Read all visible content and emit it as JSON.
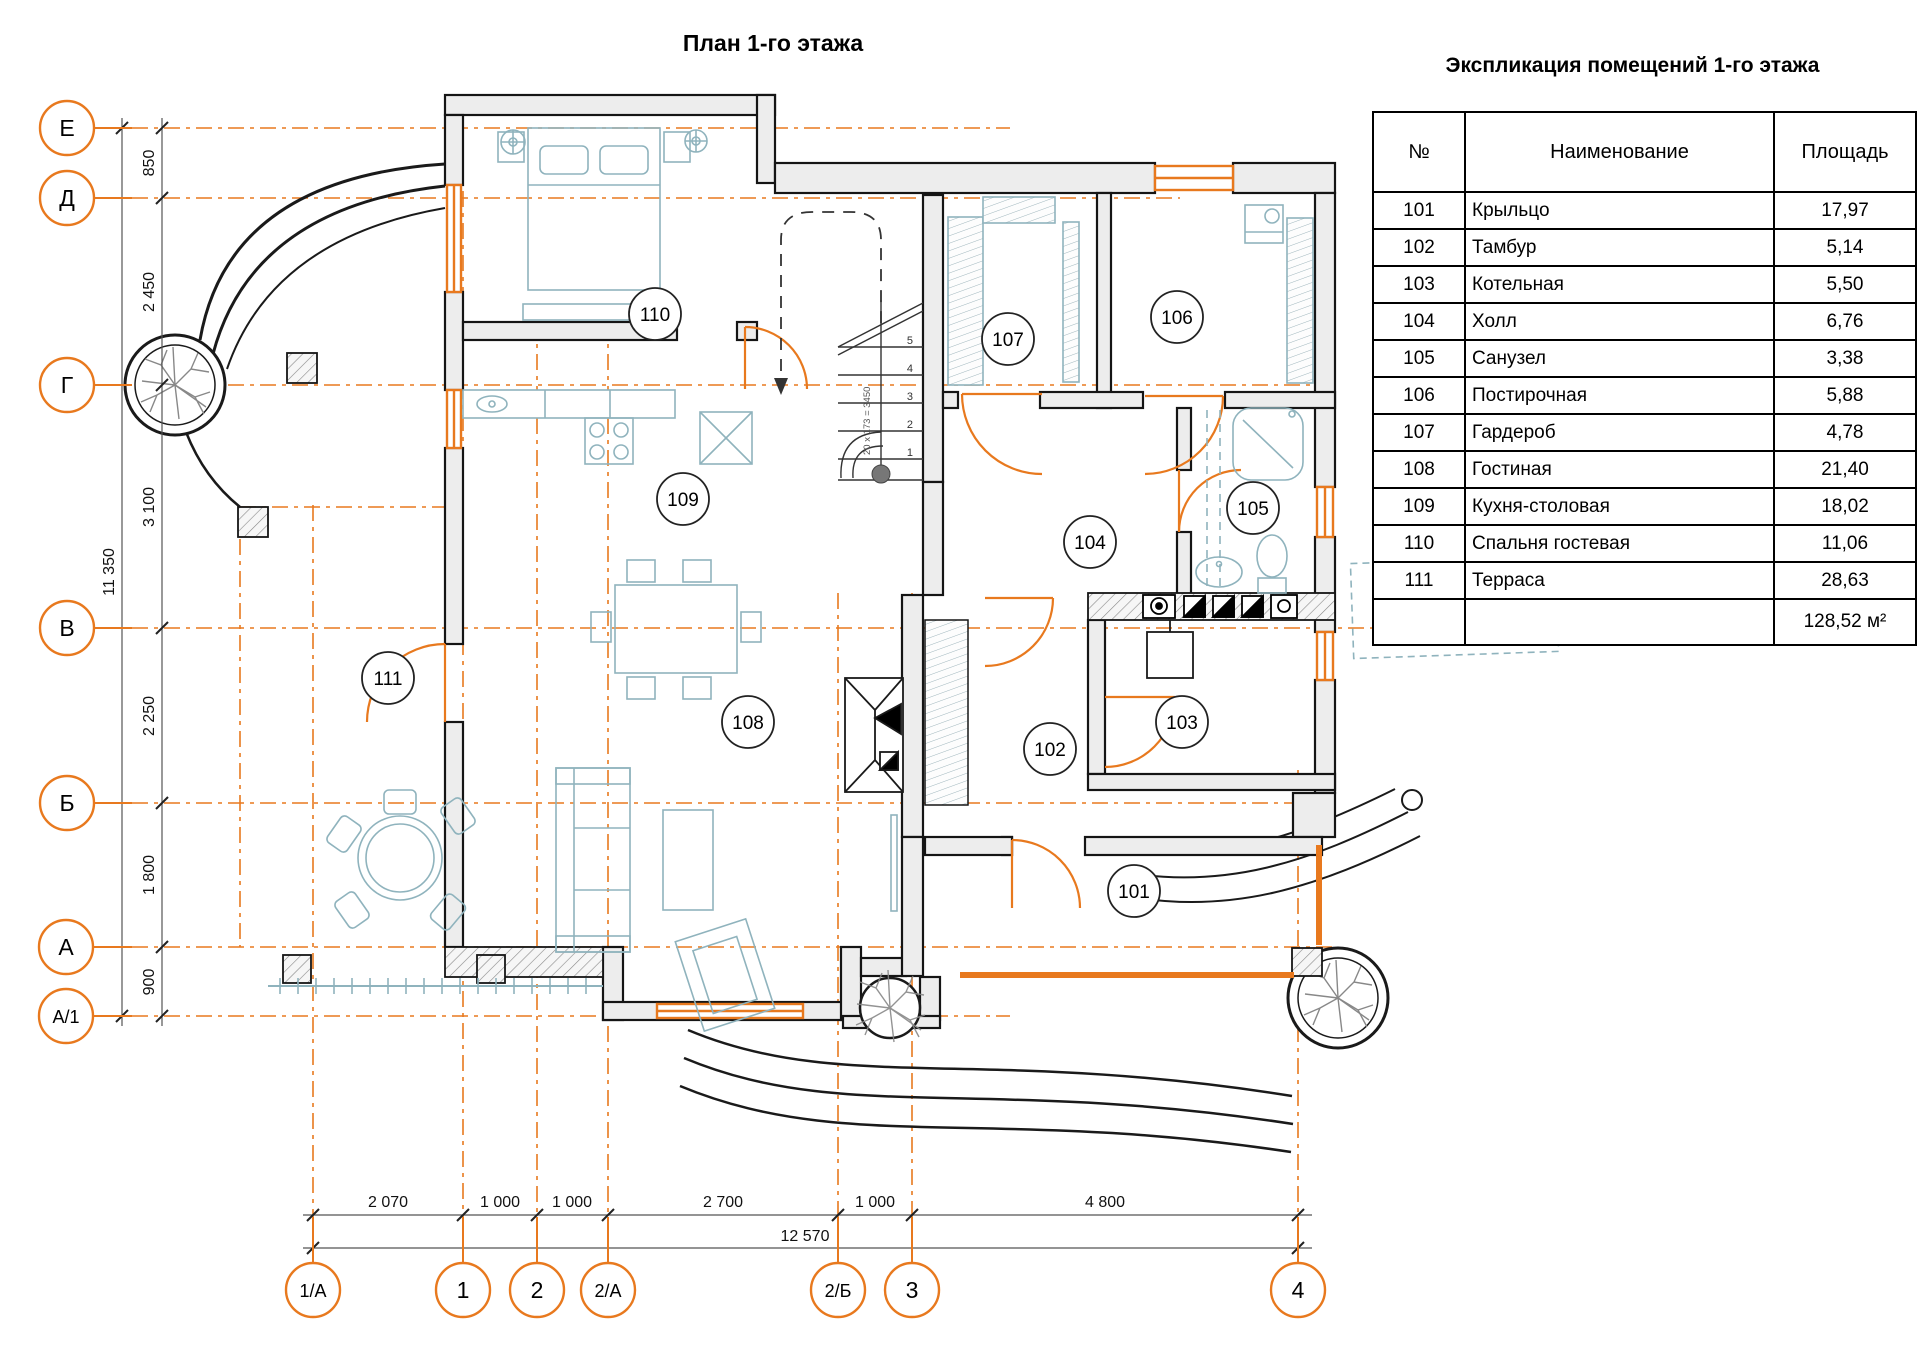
{
  "page": {
    "title": "План 1-го этажа"
  },
  "schedule": {
    "title": "Экспликация помещений 1-го этажа",
    "headers": {
      "num": "№",
      "name": "Наименование",
      "area": "Площадь"
    },
    "rows": [
      {
        "num": "101",
        "name": "Крыльцо",
        "area": "17,97"
      },
      {
        "num": "102",
        "name": "Тамбур",
        "area": "5,14"
      },
      {
        "num": "103",
        "name": "Котельная",
        "area": "5,50"
      },
      {
        "num": "104",
        "name": "Холл",
        "area": "6,76"
      },
      {
        "num": "105",
        "name": "Санузел",
        "area": "3,38"
      },
      {
        "num": "106",
        "name": "Постирочная",
        "area": "5,88"
      },
      {
        "num": "107",
        "name": "Гардероб",
        "area": "4,78"
      },
      {
        "num": "108",
        "name": "Гостиная",
        "area": "21,40"
      },
      {
        "num": "109",
        "name": "Кухня-столовая",
        "area": "18,02"
      },
      {
        "num": "110",
        "name": "Спальня гостевая",
        "area": "11,06"
      },
      {
        "num": "111",
        "name": "Терраса",
        "area": "28,63"
      }
    ],
    "total_area": "128,52 м²"
  },
  "axes": {
    "left": [
      "Е",
      "Д",
      "Г",
      "В",
      "Б",
      "А",
      "А/1"
    ],
    "bottom": [
      "1/А",
      "1",
      "2",
      "2/А",
      "2/Б",
      "3",
      "4"
    ]
  },
  "dimensions": {
    "left": [
      "850",
      "2 450",
      "3 100",
      "2 250",
      "1 800",
      "900"
    ],
    "left_total": "11 350",
    "bottom": [
      "2 070",
      "1 000",
      "1 000",
      "2 700",
      "1 000",
      "4 800"
    ],
    "bottom_total": "12 570"
  },
  "plan": {
    "room_labels": [
      "110",
      "107",
      "106",
      "109",
      "104",
      "105",
      "111",
      "108",
      "102",
      "103",
      "101"
    ],
    "stair_note": "20 х 173 = 3450"
  },
  "colors": {
    "accent": "#E8791E",
    "wall": "#1A1A1A",
    "furniture": "#8FB3BD"
  }
}
